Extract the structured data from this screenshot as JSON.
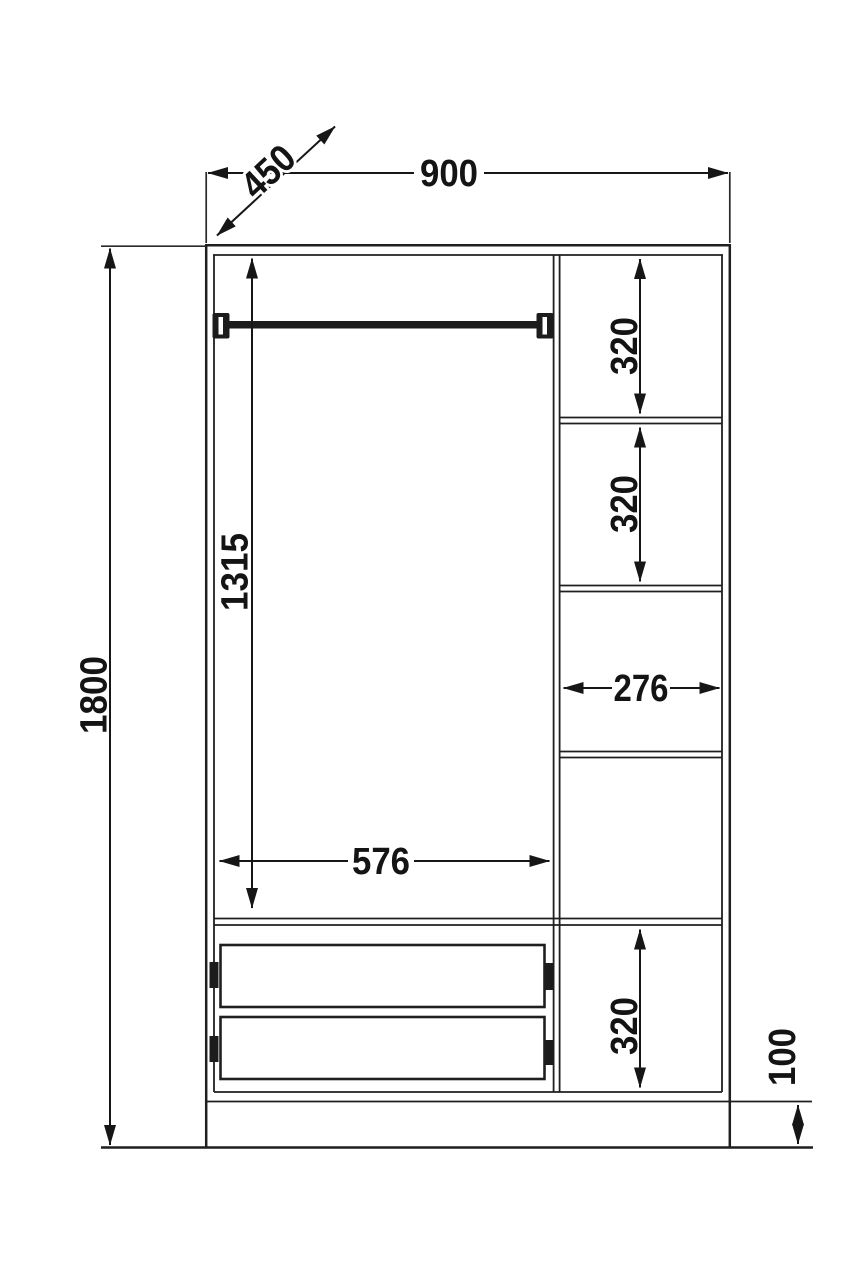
{
  "diagram": {
    "kind": "wardrobe-dimension-drawing",
    "view": "front-elevation",
    "background_color": "#ffffff",
    "line_color": "#1f1f1f",
    "dimensions": {
      "overall_width": "900",
      "depth": "450",
      "overall_height": "1800",
      "hanging_space_height": "1315",
      "drawer_section_width": "576",
      "shelf_section_width": "276",
      "shelf_spacing_top_1": "320",
      "shelf_spacing_top_2": "320",
      "shelf_spacing_bottom": "320",
      "plinth_height": "100"
    }
  }
}
